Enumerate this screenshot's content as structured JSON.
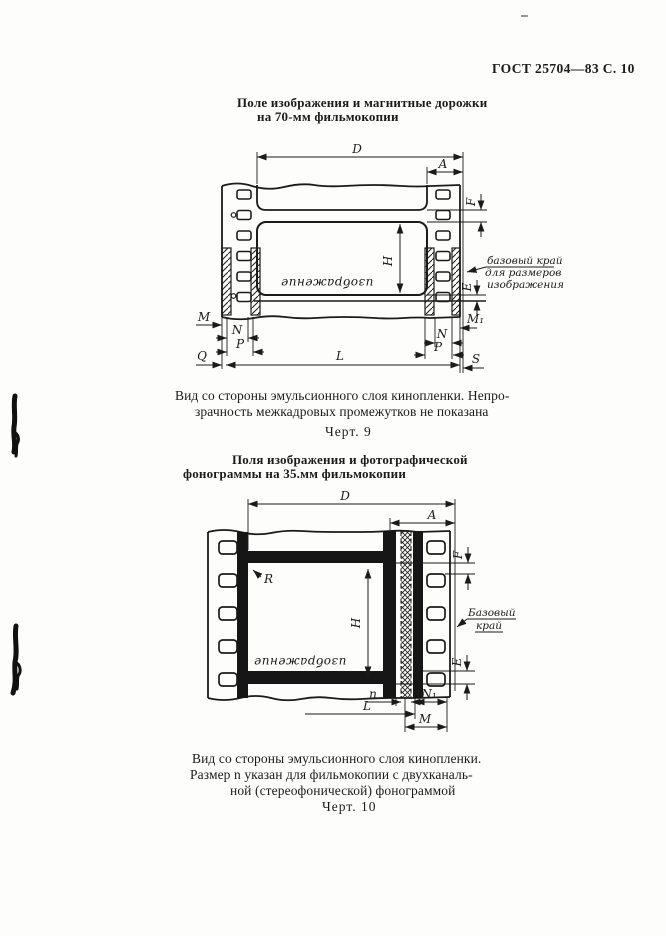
{
  "page": {
    "header": "ГОСТ 25704—83 С. 10"
  },
  "figure9": {
    "title_line1": "Поле изображения и магнитные дорожки",
    "title_line2": "на 70-мм фильмокопии",
    "image_label": "изображение",
    "base_edge_note": {
      "line1": "базовый край",
      "line2": "для размеров",
      "line3": "изображения"
    },
    "dims": {
      "D": "D",
      "A": "A",
      "F": "F",
      "E": "E",
      "H": "H",
      "M": "M",
      "N": "N",
      "P": "P",
      "Q": "Q",
      "L": "L",
      "S": "S",
      "M1": "M₁"
    },
    "caption_line1": "Вид со стороны эмульсионного слоя кинопленки. Непро-",
    "caption_line2": "зрачность межкадровых промежутков не показана",
    "fig_label": "Черт. 9"
  },
  "figure10": {
    "title_line1": "Поля изображения и фотографической",
    "title_line2": "фонограммы на 35.мм фильмокопии",
    "image_label": "изображение",
    "base_edge_note": {
      "line1": "Базовый",
      "line2": "край"
    },
    "dims": {
      "D": "D",
      "A": "A",
      "F": "F",
      "E": "E",
      "H": "H",
      "R": "R",
      "n": "n",
      "L": "L",
      "M": "M",
      "N1": "N₁"
    },
    "caption_line1": "Вид со стороны эмульсионного слоя кинопленки.",
    "caption_line2": "Размер n указан для фильмокопии с двухканаль-",
    "caption_line3": "ной (стереофонической) фонограммой",
    "fig_label": "Черт. 10"
  },
  "colors": {
    "ink": "#1b1b1b",
    "paper": "#fdfdfb"
  }
}
